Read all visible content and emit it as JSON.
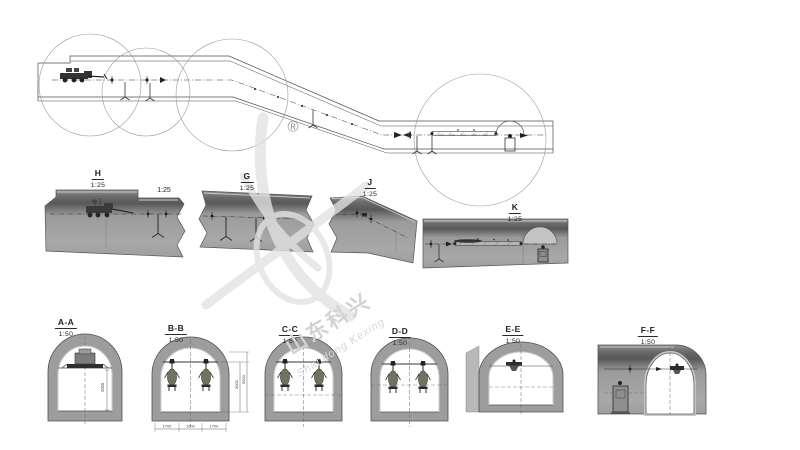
{
  "colors": {
    "background": "#ffffff",
    "linework": "#4d4d4d",
    "section_fill": "#9b9b9b",
    "section_band": "#5f5f5f",
    "ring_fill": "#9d9d9d",
    "highlight": "#cfcfcf",
    "watermark": "#d9d9d9",
    "equipment_dark": "#2b2b2b",
    "drill_body": "#72725f"
  },
  "watermark": {
    "registered_mark": "®",
    "brand_cn": "山东科兴",
    "brand_en": "Shandong Kexing"
  },
  "detail_callouts": [
    {
      "label": "H",
      "scale": "1:25"
    },
    {
      "label": "G",
      "scale": "1:25"
    },
    {
      "label": "J",
      "scale": "1:25"
    },
    {
      "label": "K",
      "scale": "1:25"
    }
  ],
  "inline_scale_label": "1:25",
  "cross_section_callouts": [
    {
      "label": "A-A",
      "scale": "1:50"
    },
    {
      "label": "B-B",
      "scale": "1:50"
    },
    {
      "label": "C-C",
      "scale": "1:50"
    },
    {
      "label": "D-D",
      "scale": "1:50"
    },
    {
      "label": "E-E",
      "scale": "1:50"
    },
    {
      "label": "F-F",
      "scale": "1:50"
    }
  ],
  "dimensions": {
    "aa_height": "2000",
    "bb_heights": [
      "3000",
      "5600"
    ],
    "bb_widths": [
      "1700",
      "1500",
      "1700"
    ]
  }
}
